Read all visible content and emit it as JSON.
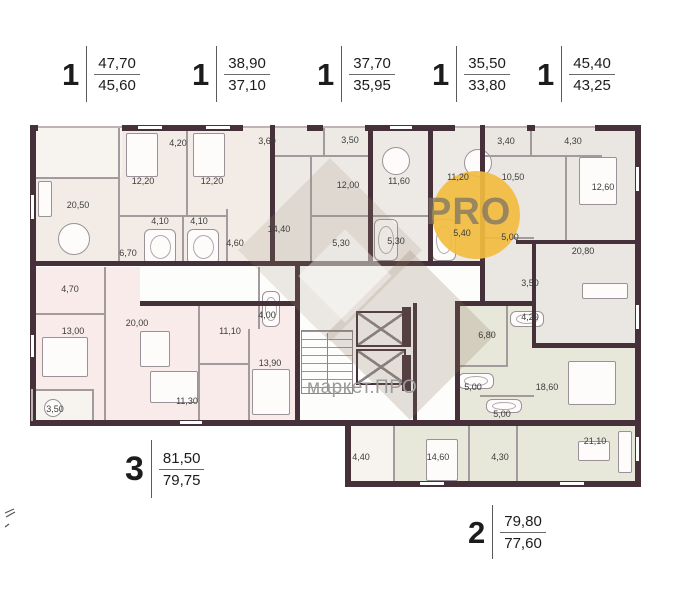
{
  "watermark": {
    "logo_text": "PRO",
    "site_text": "маркет.ПРО",
    "logo_color": "#f2bc3f"
  },
  "apartments": [
    {
      "rooms": "1",
      "area_total": "47,70",
      "area_living": "45,60"
    },
    {
      "rooms": "1",
      "area_total": "38,90",
      "area_living": "37,10"
    },
    {
      "rooms": "1",
      "area_total": "37,70",
      "area_living": "35,95"
    },
    {
      "rooms": "1",
      "area_total": "35,50",
      "area_living": "33,80"
    },
    {
      "rooms": "1",
      "area_total": "45,40",
      "area_living": "43,25"
    },
    {
      "rooms": "3",
      "area_total": "81,50",
      "area_living": "79,75"
    },
    {
      "rooms": "2",
      "area_total": "79,80",
      "area_living": "77,60"
    }
  ],
  "plan": {
    "wall_color": "#46313a",
    "room_labels": [
      {
        "area": "4,20",
        "x": 148,
        "y": 18
      },
      {
        "area": "12,20",
        "x": 113,
        "y": 56
      },
      {
        "area": "12,20",
        "x": 182,
        "y": 56
      },
      {
        "area": "20,50",
        "x": 48,
        "y": 80
      },
      {
        "area": "4,10",
        "x": 130,
        "y": 96
      },
      {
        "area": "4,10",
        "x": 169,
        "y": 96
      },
      {
        "area": "4,60",
        "x": 205,
        "y": 118
      },
      {
        "area": "6,70",
        "x": 98,
        "y": 128
      },
      {
        "area": "3,60",
        "x": 237,
        "y": 16
      },
      {
        "area": "3,50",
        "x": 320,
        "y": 15
      },
      {
        "area": "12,00",
        "x": 318,
        "y": 60
      },
      {
        "area": "14,40",
        "x": 249,
        "y": 104
      },
      {
        "area": "5,30",
        "x": 311,
        "y": 118
      },
      {
        "area": "11,60",
        "x": 369,
        "y": 56
      },
      {
        "area": "5,30",
        "x": 366,
        "y": 116
      },
      {
        "area": "11,20",
        "x": 428,
        "y": 52
      },
      {
        "area": "5,40",
        "x": 432,
        "y": 108
      },
      {
        "area": "3,40",
        "x": 476,
        "y": 16
      },
      {
        "area": "4,30",
        "x": 543,
        "y": 16
      },
      {
        "area": "10,50",
        "x": 483,
        "y": 52
      },
      {
        "area": "12,60",
        "x": 573,
        "y": 62
      },
      {
        "area": "5,00",
        "x": 480,
        "y": 112
      },
      {
        "area": "20,80",
        "x": 553,
        "y": 126
      },
      {
        "area": "4,70",
        "x": 40,
        "y": 164
      },
      {
        "area": "13,00",
        "x": 43,
        "y": 206
      },
      {
        "area": "20,00",
        "x": 107,
        "y": 198
      },
      {
        "area": "11,10",
        "x": 200,
        "y": 206
      },
      {
        "area": "4,00",
        "x": 237,
        "y": 190
      },
      {
        "area": "13,90",
        "x": 240,
        "y": 238
      },
      {
        "area": "11,30",
        "x": 157,
        "y": 276
      },
      {
        "area": "3,50",
        "x": 25,
        "y": 284
      },
      {
        "area": "6,80",
        "x": 457,
        "y": 210
      },
      {
        "area": "3,50",
        "x": 500,
        "y": 158
      },
      {
        "area": "4,20",
        "x": 500,
        "y": 192
      },
      {
        "area": "5,00",
        "x": 443,
        "y": 262
      },
      {
        "area": "18,60",
        "x": 517,
        "y": 262
      },
      {
        "area": "5,00",
        "x": 472,
        "y": 289
      },
      {
        "area": "4,40",
        "x": 331,
        "y": 332
      },
      {
        "area": "14,60",
        "x": 408,
        "y": 332
      },
      {
        "area": "4,30",
        "x": 470,
        "y": 332
      },
      {
        "area": "21,10",
        "x": 565,
        "y": 316
      }
    ]
  }
}
